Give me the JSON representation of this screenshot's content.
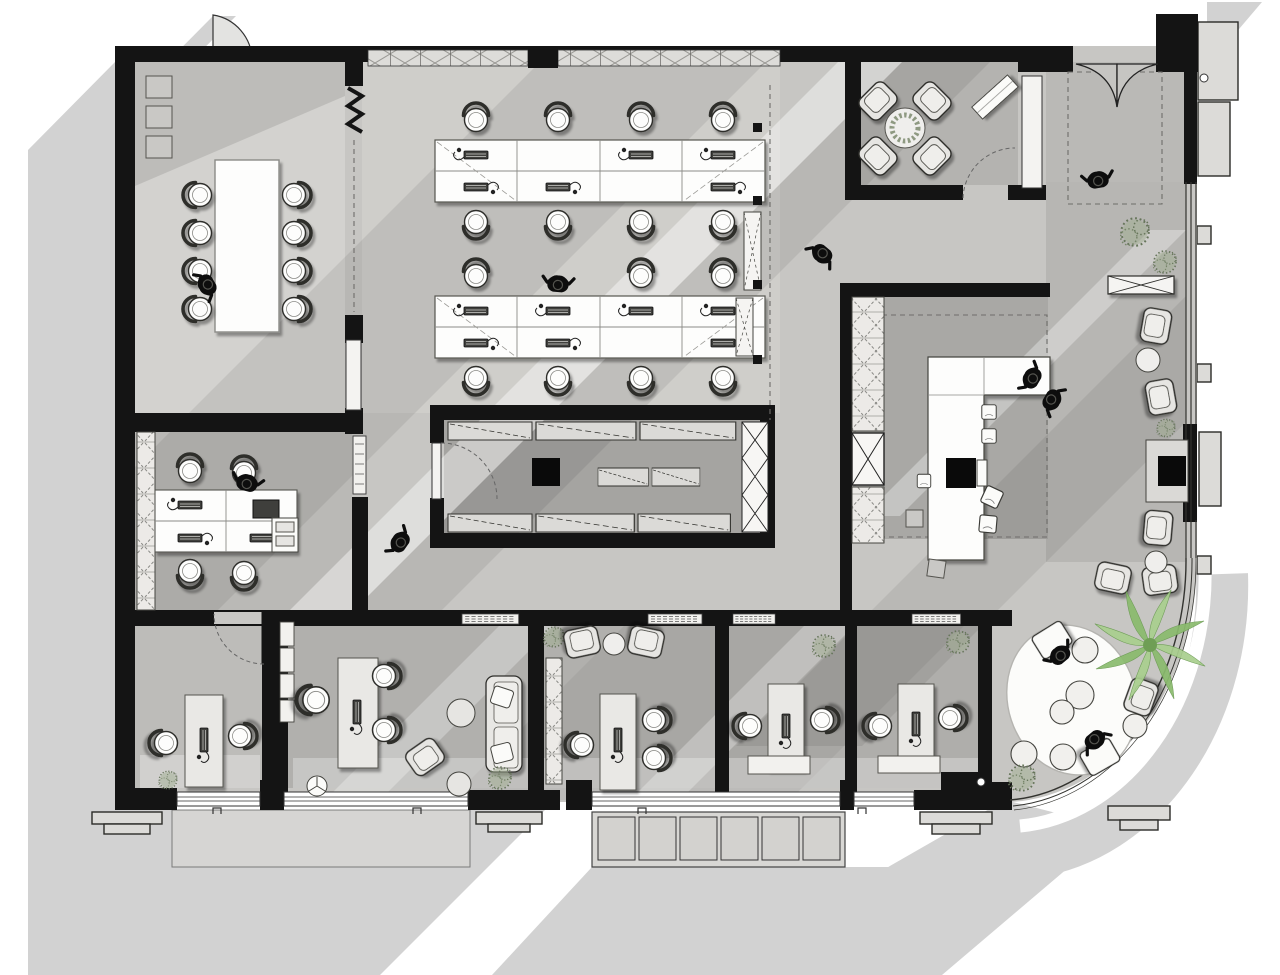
{
  "document": {
    "type": "architectural floor plan",
    "title": "Office Floor Plan — top-down render",
    "style": "monochrome plan with 45° cast shadows, green plants"
  },
  "palette": {
    "background": "#ffffff",
    "walls": "#141414",
    "shadow": "#d2d2d2",
    "floor_light": "#d3d2cf",
    "floor_mid": "#c7c6c3",
    "floor_dark": "#aaa9a6",
    "furniture_white": "#fcfcfa",
    "furniture_gray": "#e6e5e2",
    "plant_green": "#8cb873",
    "people": "#0d0d0d"
  },
  "people_total": 10,
  "plants_total": 11,
  "rooms": [
    {
      "name": "Meeting Room",
      "furniture": [
        "conference table",
        "8 chairs",
        "3 storage cubes",
        "folding partition"
      ],
      "occupants": 1
    },
    {
      "name": "Open Office",
      "furniture": [
        "2 bench desks",
        "16 task chairs",
        "keyboards",
        "lockers",
        "columns"
      ],
      "occupants": 1
    },
    {
      "name": "Lounge Meeting Room",
      "furniture": [
        "4 armchairs",
        "round planter table",
        "angled console"
      ],
      "occupants": 0
    },
    {
      "name": "Entrance Vestibule",
      "furniture": [
        "double swing doors"
      ],
      "occupants": 1
    },
    {
      "name": "Kitchen Pantry",
      "furniture": [
        "L-shaped island counter",
        "cooktop",
        "stools",
        "tall cabinet wall"
      ],
      "occupants": 2
    },
    {
      "name": "Storage Room",
      "furniture": [
        "wall shelving",
        "locker column",
        "freestanding shelves"
      ],
      "occupants": 0
    },
    {
      "name": "Team Office",
      "furniture": [
        "4 desks",
        "4 chairs",
        "printer table",
        "cabinet strip"
      ],
      "occupants": 1
    },
    {
      "name": "Private Office 1",
      "furniture": [
        "desk",
        "2 chairs",
        "plant"
      ],
      "occupants": 0
    },
    {
      "name": "Executive Office",
      "furniture": [
        "desk",
        "3 chairs",
        "sofa",
        "lounge chair",
        "2 poufs",
        "wall shelves",
        "plants"
      ],
      "occupants": 0
    },
    {
      "name": "Private Office 2",
      "furniture": [
        "desk",
        "3 chairs",
        "2 lounge chairs",
        "coffee table",
        "wardrobe",
        "plant"
      ],
      "occupants": 0
    },
    {
      "name": "Private Office 3",
      "furniture": [
        "desk",
        "credenza",
        "2 chairs",
        "plant"
      ],
      "occupants": 0
    },
    {
      "name": "Private Office 4",
      "furniture": [
        "desk",
        "credenza",
        "2 chairs",
        "plant"
      ],
      "occupants": 0
    },
    {
      "name": "Winter Garden Lounge",
      "furniture": [
        "oval rug",
        "6 poufs",
        "armchairs",
        "palm tree",
        "fern"
      ],
      "occupants": 2
    },
    {
      "name": "Window Gallery",
      "furniture": [
        "armchairs",
        "side tables",
        "x-bench",
        "fireplace",
        "ferns"
      ],
      "occupants": 2
    }
  ]
}
